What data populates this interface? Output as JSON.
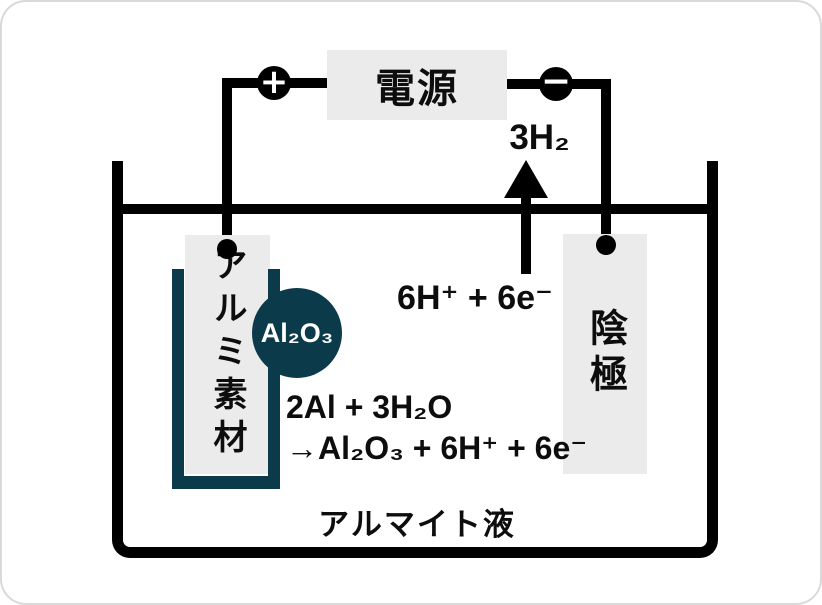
{
  "colors": {
    "teal": "#0b3a4a",
    "panel": "#ebebeb",
    "line": "#000000",
    "ink": "#0d0d0d"
  },
  "power_supply": {
    "label": "電源",
    "plus_symbol": "+",
    "minus_symbol": "−"
  },
  "anode": {
    "label": "アルミ素材"
  },
  "cathode": {
    "label": "陰極"
  },
  "oxide": {
    "label": "Al₂O₃"
  },
  "reaction": {
    "gas_label": "3H₂",
    "ion_label": "6H⁺ + 6e⁻",
    "equation_line1": "2Al + 3H₂O",
    "equation_line2": "→Al₂O₃ + 6H⁺ + 6e⁻"
  },
  "solution": {
    "label": "アルマイト液"
  }
}
